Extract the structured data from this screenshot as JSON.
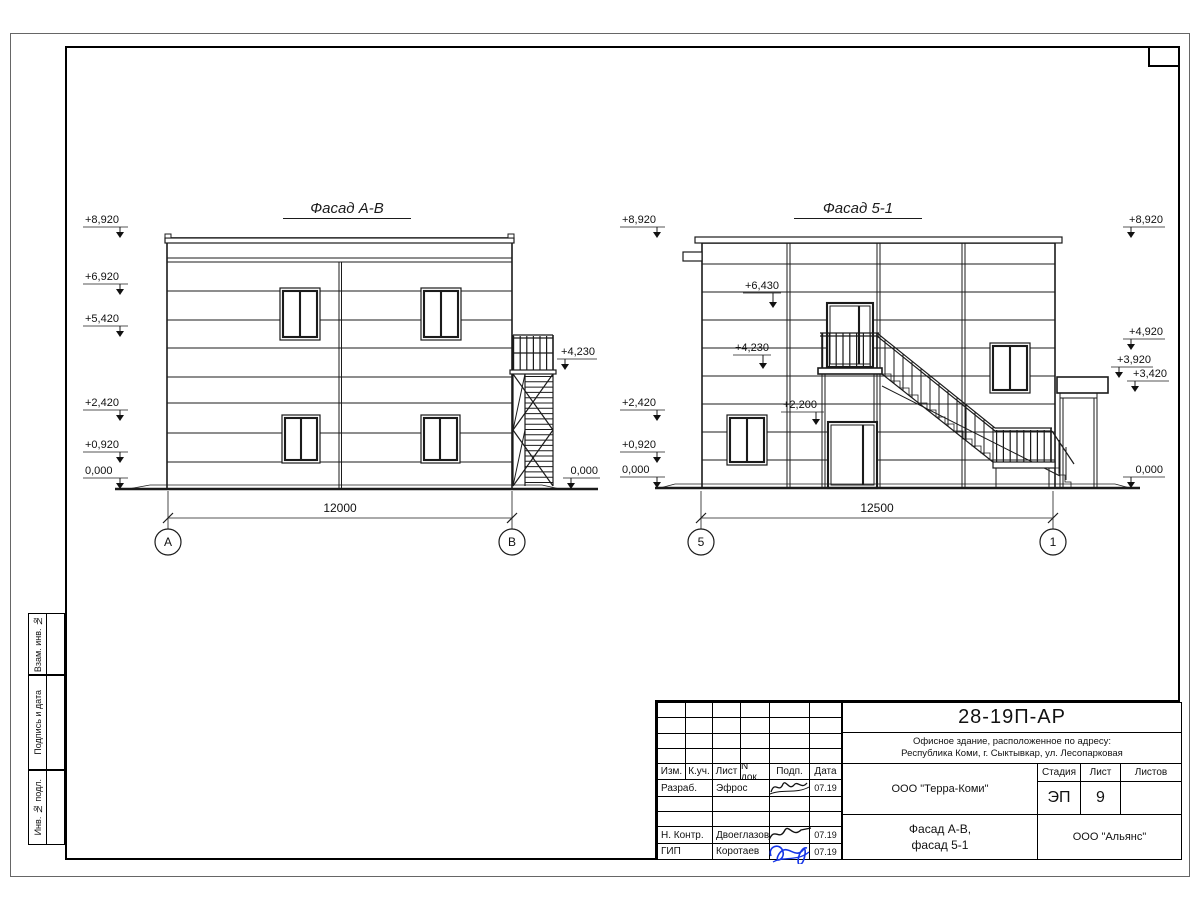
{
  "sheet": {
    "code": "28-19П-АР",
    "object_line1": "Офисное здание, расположенное по адресу:",
    "object_line2": "Республика Коми, г. Сыктывкар, ул. Лесопарковая",
    "client": "ООО \"Терра-Коми\"",
    "doc_title_line1": "Фасад А-В,",
    "doc_title_line2": "фасад 5-1",
    "contractor": "ООО \"Альянс\"",
    "labels": {
      "stage": "Стадия",
      "sheet": "Лист",
      "sheets": "Листов"
    },
    "values": {
      "stage": "ЭП",
      "sheet_no": "9",
      "sheets_total": ""
    },
    "cols": {
      "izm": "Изм.",
      "kuch": "К.уч.",
      "list": "Лист",
      "ndok": "N док.",
      "podp": "Подп.",
      "data": "Дата"
    },
    "rows": [
      {
        "role": "Разраб.",
        "name": "Эфрос",
        "date": "07.19"
      },
      {
        "role": "",
        "name": "",
        "date": ""
      },
      {
        "role": "",
        "name": "",
        "date": ""
      },
      {
        "role": "Н. Контр.",
        "name": "Двоеглазов",
        "date": "07.19"
      },
      {
        "role": "ГИП",
        "name": "Коротаев",
        "date": "07.19"
      }
    ],
    "margin_labels": [
      "Взам. инв. №",
      "Подпись и дата",
      "Инв. № подл."
    ]
  },
  "facade_ab": {
    "title": "Фасад А-В",
    "dimension": "12000",
    "axes": [
      "А",
      "В"
    ],
    "marks_left": [
      "+8,920",
      "+6,920",
      "+5,420",
      "+2,420",
      "+0,920",
      "0,000"
    ],
    "marks_right": [
      "+4,230",
      "0,000"
    ]
  },
  "facade_51": {
    "title": "Фасад 5-1",
    "dimension": "12500",
    "axes": [
      "5",
      "1"
    ],
    "marks_left": [
      "+8,920",
      "+2,420",
      "+0,920",
      "0,000"
    ],
    "marks_inner": [
      "+6,430",
      "+4,230",
      "+2,200"
    ],
    "marks_right": [
      "+8,920",
      "+4,920",
      "+3,920",
      "+3,420",
      "0,000"
    ]
  }
}
